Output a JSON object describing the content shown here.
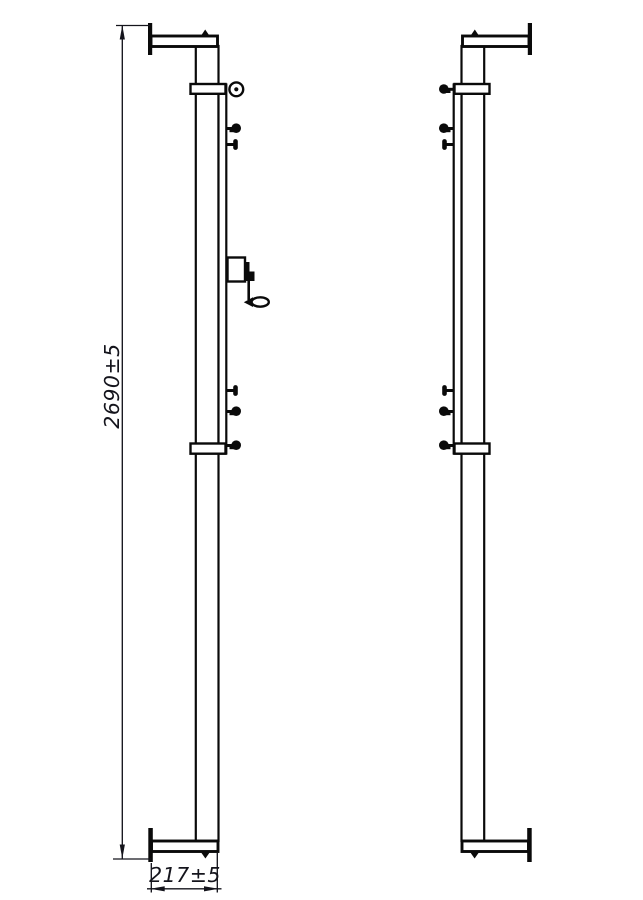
{
  "colors": {
    "background": "#ffffff",
    "line": "#0a0a0a",
    "dimension": "#14141c"
  },
  "dimensions": {
    "height": {
      "label": "2690±5"
    },
    "width": {
      "label": "217±5"
    }
  }
}
